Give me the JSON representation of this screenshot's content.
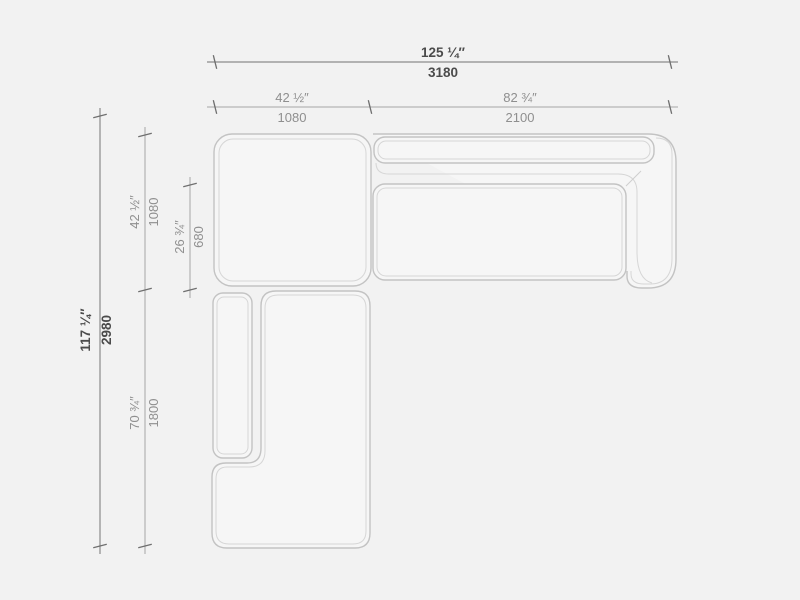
{
  "drawing": {
    "kind": "sectional-sofa-plan-drawing",
    "units": [
      "inches",
      "millimeters"
    ]
  },
  "dims": {
    "total_width": {
      "in": "125 ¼″",
      "mm": "3180"
    },
    "left_width": {
      "in": "42 ½″",
      "mm": "1080"
    },
    "right_width": {
      "in": "82 ¾″",
      "mm": "2100"
    },
    "total_depth": {
      "in": "117 ¼″",
      "mm": "2980"
    },
    "corner_depth": {
      "in": "42 ½″",
      "mm": "1080"
    },
    "seat_depth": {
      "in": "26 ¾″",
      "mm": "680"
    },
    "chaise_depth": {
      "in": "70 ¾″",
      "mm": "1800"
    }
  },
  "colors": {
    "background": "#f2f2f2",
    "module_fill": "#f6f6f6",
    "outline": "#c3c3c3",
    "outline_inner": "#d6d6d6",
    "dim_line": "#a6a6a6",
    "dim_line_bold": "#8c8c8c",
    "tick": "#6f6f6f",
    "dim_text": "#8f8f8f",
    "dim_text_bold": "#4b4b4b"
  }
}
